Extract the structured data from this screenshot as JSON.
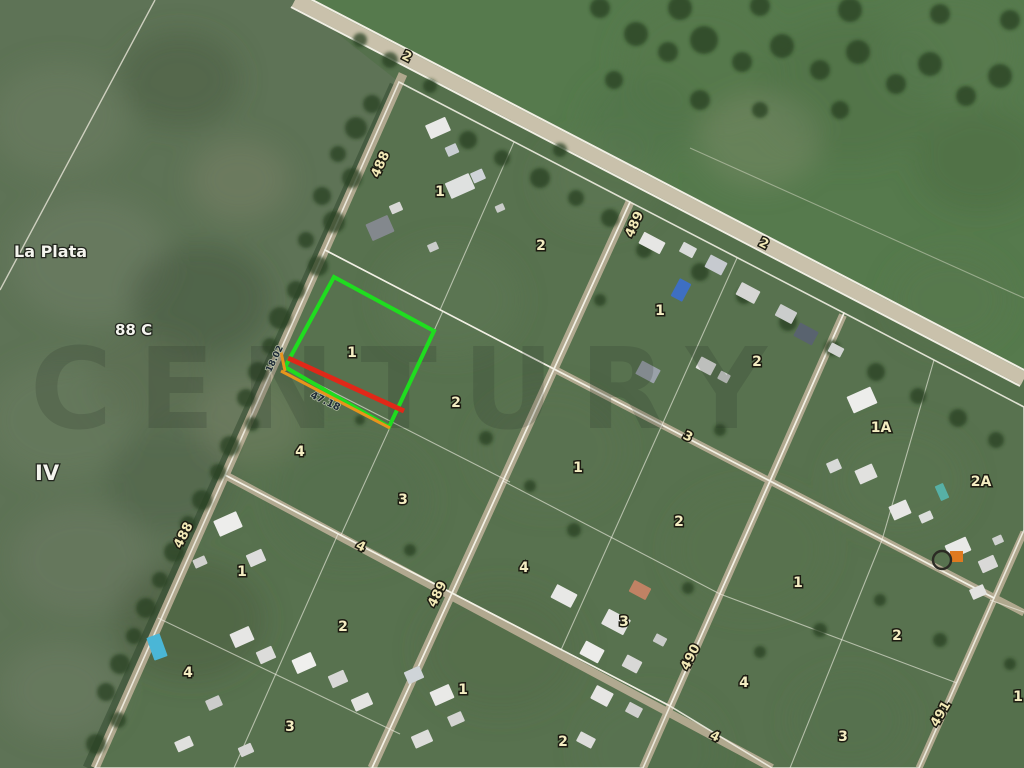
{
  "map": {
    "type": "satellite-parcel-map",
    "watermark": "CENTURY",
    "colors": {
      "field_base": "#55704c",
      "road_tan": "#b5ab91",
      "boundary_white": "#f4f1e6",
      "label_yellow": "#f2e9b6",
      "highlight_green": "#1fdd1f",
      "highlight_red": "#e02818",
      "highlight_orange": "#e8941c"
    },
    "area_labels": [
      {
        "text": "La Plata",
        "x": 14,
        "y": 257,
        "size": 16,
        "a": "start"
      },
      {
        "text": "88 C",
        "x": 115,
        "y": 335,
        "size": 15,
        "a": "start"
      },
      {
        "text": "IV",
        "x": 35,
        "y": 480,
        "size": 21,
        "a": "start"
      }
    ],
    "street_labels": [
      {
        "text": "2",
        "x": 405,
        "y": 60,
        "rot": 27
      },
      {
        "text": "488",
        "x": 384,
        "y": 166,
        "rot": -66
      },
      {
        "text": "489",
        "x": 638,
        "y": 226,
        "rot": -66
      },
      {
        "text": "2",
        "x": 762,
        "y": 247,
        "rot": 27
      },
      {
        "text": "3",
        "x": 686,
        "y": 440,
        "rot": 27
      },
      {
        "text": "4",
        "x": 359,
        "y": 550,
        "rot": 26
      },
      {
        "text": "488",
        "x": 187,
        "y": 537,
        "rot": -63
      },
      {
        "text": "489",
        "x": 441,
        "y": 596,
        "rot": -63
      },
      {
        "text": "490",
        "x": 694,
        "y": 659,
        "rot": -63
      },
      {
        "text": "4",
        "x": 713,
        "y": 740,
        "rot": 26
      },
      {
        "text": "491",
        "x": 944,
        "y": 716,
        "rot": -60
      }
    ],
    "parcel_labels": [
      {
        "text": "1",
        "x": 440,
        "y": 196
      },
      {
        "text": "2",
        "x": 541,
        "y": 250
      },
      {
        "text": "1",
        "x": 660,
        "y": 315
      },
      {
        "text": "2",
        "x": 757,
        "y": 366
      },
      {
        "text": "1A",
        "x": 881,
        "y": 432
      },
      {
        "text": "2A",
        "x": 981,
        "y": 486
      },
      {
        "text": "1",
        "x": 352,
        "y": 357
      },
      {
        "text": "2",
        "x": 456,
        "y": 407
      },
      {
        "text": "4",
        "x": 300,
        "y": 456
      },
      {
        "text": "3",
        "x": 403,
        "y": 504
      },
      {
        "text": "1",
        "x": 578,
        "y": 472
      },
      {
        "text": "2",
        "x": 679,
        "y": 526
      },
      {
        "text": "4",
        "x": 524,
        "y": 572
      },
      {
        "text": "3",
        "x": 624,
        "y": 626
      },
      {
        "text": "1",
        "x": 798,
        "y": 587
      },
      {
        "text": "2",
        "x": 897,
        "y": 640
      },
      {
        "text": "4",
        "x": 744,
        "y": 687
      },
      {
        "text": "3",
        "x": 843,
        "y": 741
      },
      {
        "text": "1",
        "x": 1018,
        "y": 701
      },
      {
        "text": "1",
        "x": 242,
        "y": 576
      },
      {
        "text": "2",
        "x": 343,
        "y": 631
      },
      {
        "text": "4",
        "x": 188,
        "y": 677
      },
      {
        "text": "3",
        "x": 290,
        "y": 731
      },
      {
        "text": "1",
        "x": 463,
        "y": 694
      },
      {
        "text": "2",
        "x": 563,
        "y": 746
      }
    ],
    "measure_labels": [
      {
        "text": "18.02",
        "x": 277,
        "y": 360,
        "rot": -64,
        "size": 9
      },
      {
        "text": "47.18",
        "x": 324,
        "y": 404,
        "rot": 26,
        "size": 10
      }
    ],
    "highlight": {
      "lot_label": "1",
      "outline_color": "#1fdd1f",
      "front_line_color": "#e02818",
      "secondary_line_color": "#e8941c"
    },
    "marker": {
      "icon": "circle-marker"
    }
  }
}
